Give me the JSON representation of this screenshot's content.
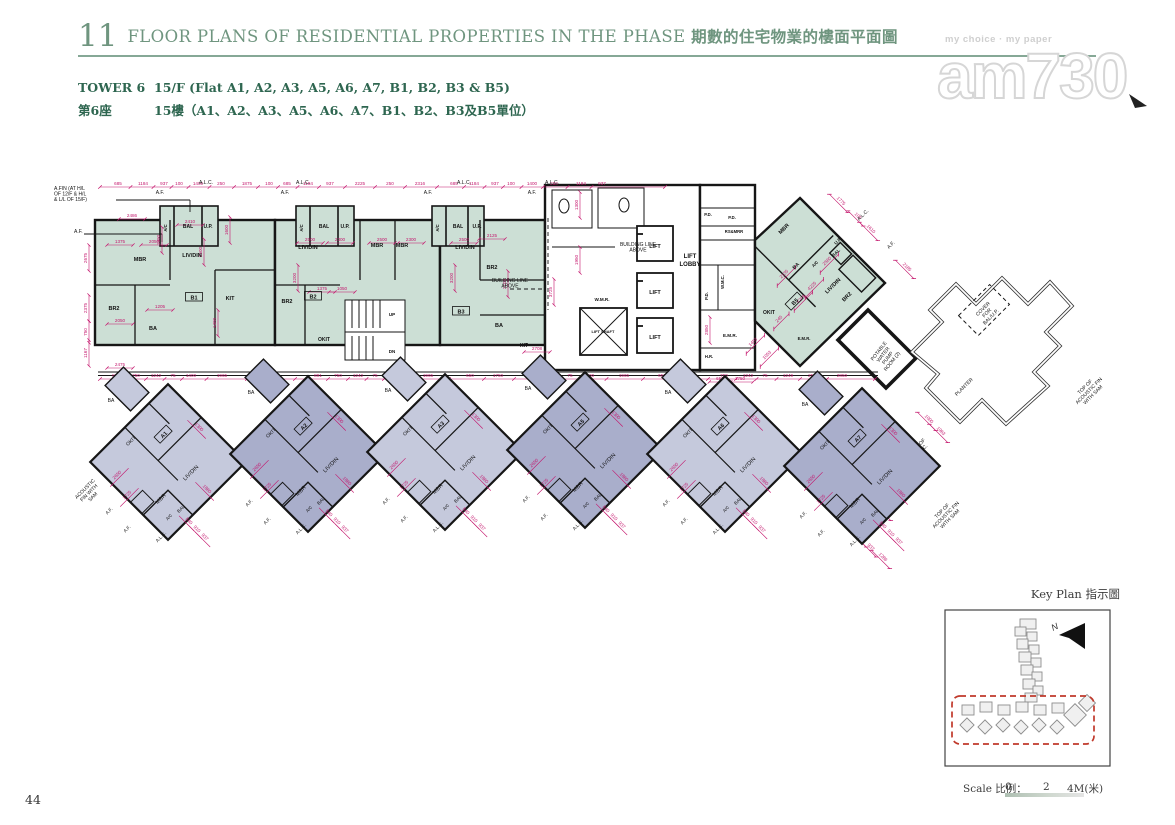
{
  "page": {
    "number": "44",
    "section_number": "11",
    "title_en": "FLOOR PLANS OF RESIDENTIAL PROPERTIES IN THE PHASE",
    "title_zh": "期數的住宅物業的樓面平面圖",
    "tower_label_en": "TOWER 6",
    "tower_label_zh": "第6座",
    "floor_label_en": "15/F (Flat A1, A2, A3, A5, A6, A7, B1, B2, B3 & B5)",
    "floor_label_zh": "15樓（A1、A2、A3、A5、A6、A7、B1、B2、B3及B5單位）"
  },
  "watermark": {
    "tagline": "my choice · my paper",
    "logo": "am730"
  },
  "key_plan": {
    "title": "Key Plan 指示圖",
    "north_label": "N",
    "scale_label": "Scale 比例：",
    "tick_0": "0",
    "tick_1": "2",
    "tick_2": "4M(米)"
  },
  "colors": {
    "header_green": "#6f957f",
    "header_dark_green": "#2e6650",
    "rule": "#86a896",
    "wall": "#161616",
    "dim": "#c4156c",
    "teal": "#ccdfd5",
    "purple_light": "#c5c9dc",
    "purple_dark": "#a9aecb",
    "keyplan_red": "#c0392b",
    "keyplan_gray": "#8d8d8d"
  },
  "plan": {
    "room_labels": [
      [
        "MBR",
        100,
        101
      ],
      [
        "LIV/DIN",
        152,
        97
      ],
      [
        "BR2",
        74,
        150
      ],
      [
        "BA",
        113,
        170
      ],
      [
        "KIT",
        190,
        140
      ],
      [
        "A/C",
        127,
        68,
        -90,
        4.2
      ],
      [
        "BAL",
        148,
        68,
        0,
        5
      ],
      [
        "U.P.",
        168,
        68,
        0,
        5
      ],
      [
        "LIV/DIN",
        268,
        89
      ],
      [
        "MBR",
        337,
        87
      ],
      [
        "BR2",
        247,
        143
      ],
      [
        "OKIT",
        284,
        181,
        0,
        5
      ],
      [
        "A/C",
        263,
        68,
        -90,
        4.2
      ],
      [
        "BAL",
        284,
        68,
        0,
        5
      ],
      [
        "U.P.",
        305,
        68,
        0,
        5
      ],
      [
        "UP",
        352,
        156,
        0,
        4.5
      ],
      [
        "DN",
        352,
        193,
        0,
        4.5
      ],
      [
        "MBR",
        362,
        87
      ],
      [
        "LIV/DIN",
        425,
        89
      ],
      [
        "BR2",
        452,
        109
      ],
      [
        "BA",
        459,
        167
      ],
      [
        "KIT",
        484,
        187,
        0,
        5
      ],
      [
        "A/C",
        399,
        68,
        -90,
        4.2
      ],
      [
        "BAL",
        418,
        68,
        0,
        5
      ],
      [
        "U.P.",
        437,
        68,
        0,
        5
      ],
      [
        "W.M.R.",
        562,
        141,
        0,
        4.6
      ],
      [
        "LIFT",
        615,
        88,
        0,
        5.5
      ],
      [
        "LIFT",
        615,
        134,
        0,
        5.5
      ],
      [
        "LIFT",
        615,
        179,
        0,
        5.5
      ],
      [
        "LIFT SHAFT",
        563,
        173,
        0,
        4.0
      ],
      [
        "LIFT",
        650,
        98,
        0,
        6
      ],
      [
        "LOBBY",
        650,
        106,
        0,
        6
      ],
      [
        "P.D.",
        668,
        56,
        0,
        4.2
      ],
      [
        "P.D.",
        692,
        59,
        0,
        4.2
      ],
      [
        "RS&MRR",
        694,
        73,
        0,
        4.2
      ],
      [
        "W.M.C.",
        684,
        122,
        -90,
        4.2
      ],
      [
        "P.D.",
        668,
        136,
        -90,
        4.2
      ],
      [
        "E.M.R.",
        690,
        177,
        0,
        4.6
      ],
      [
        "H.R.",
        669,
        198,
        0,
        4.2
      ],
      [
        "MBR",
        745,
        70,
        -45
      ],
      [
        "BA",
        757,
        107,
        -45,
        5
      ],
      [
        "U.P.",
        799,
        82,
        -45,
        4.6
      ],
      [
        "BAL",
        797,
        94,
        -45,
        4.6
      ],
      [
        "A/C",
        776,
        105,
        -45,
        4.2
      ],
      [
        "LIV/DIN",
        794,
        127,
        -45
      ],
      [
        "BR2",
        808,
        138,
        -45
      ],
      [
        "OKIT",
        729,
        154,
        0,
        5
      ],
      [
        "E.M.R.",
        764,
        180,
        0,
        4.2
      ]
    ],
    "unit_boxes": [
      [
        "B1",
        154,
        138,
        0
      ],
      [
        "B2",
        273,
        137,
        0
      ],
      [
        "B3",
        421,
        152,
        0
      ],
      [
        "B5",
        755,
        142,
        -45
      ]
    ],
    "annotations": [
      {
        "l": [
          "A.FIN (AT H/L",
          "OF 12/F & H/L",
          "& L/L OF 15/F)"
        ],
        "x": 14,
        "y": 30,
        "a": "start"
      },
      {
        "l": [
          "A.F."
        ],
        "x": 34,
        "y": 73,
        "a": "start"
      },
      {
        "l": [
          "BUILDING LINE",
          "ABOVE"
        ],
        "x": 598,
        "y": 86
      },
      {
        "l": [
          "BUILDING LINE",
          "ABOVE"
        ],
        "x": 470,
        "y": 122
      },
      {
        "l": [
          "ACOUSTIC",
          "FIN WITH",
          "SAM"
        ],
        "x": 46,
        "y": 330,
        "r": -45
      },
      {
        "l": [
          "POTABLE",
          "WATER",
          "PUMP",
          "ROOM (2)"
        ],
        "x": 840,
        "y": 192,
        "r": -52
      },
      {
        "l": [
          "PLANTER"
        ],
        "x": 925,
        "y": 228,
        "r": -45
      },
      {
        "l": [
          "COVER",
          "FOR",
          "BAL/U.P."
        ],
        "x": 944,
        "y": 150,
        "r": -45
      },
      {
        "l": [
          "TOP OF",
          "ACOUSTIC FIN",
          "WITH SAM"
        ],
        "x": 1046,
        "y": 228,
        "r": -45
      },
      {
        "l": [
          "TOP OF",
          "A.L.C."
        ],
        "x": 879,
        "y": 287,
        "r": -45
      },
      {
        "l": [
          "A.F."
        ],
        "x": 860,
        "y": 307,
        "r": -45
      },
      {
        "l": [
          "TOP OF",
          "ACOUSTIC FIN",
          "WITH SAM"
        ],
        "x": 903,
        "y": 352,
        "r": -45
      },
      {
        "l": [
          "A.F."
        ],
        "x": 120,
        "y": 34
      },
      {
        "l": [
          "A.L.C."
        ],
        "x": 166,
        "y": 24
      },
      {
        "l": [
          "A.F."
        ],
        "x": 245,
        "y": 34
      },
      {
        "l": [
          "A.L.C."
        ],
        "x": 263,
        "y": 24
      },
      {
        "l": [
          "A.F."
        ],
        "x": 388,
        "y": 34
      },
      {
        "l": [
          "A.L.C."
        ],
        "x": 424,
        "y": 24
      },
      {
        "l": [
          "A.F."
        ],
        "x": 492,
        "y": 34
      },
      {
        "l": [
          "A.L.C."
        ],
        "x": 512,
        "y": 24
      },
      {
        "l": [
          "A.L.C."
        ],
        "x": 824,
        "y": 56,
        "r": -45
      },
      {
        "l": [
          "A.F."
        ],
        "x": 852,
        "y": 86,
        "r": -45
      }
    ],
    "dim_top": {
      "y": 27,
      "x1": 60,
      "x2": 625,
      "labels": [
        [
          "685",
          78
        ],
        [
          "1184",
          103
        ],
        [
          "937",
          124
        ],
        [
          "100",
          139
        ],
        [
          "1400",
          158
        ],
        [
          "250",
          181
        ],
        [
          "1875",
          207
        ],
        [
          "100",
          229
        ],
        [
          "685",
          247
        ],
        [
          "1184",
          268
        ],
        [
          "937",
          290
        ],
        [
          "2225",
          320
        ],
        [
          "250",
          350
        ],
        [
          "2316",
          380
        ],
        [
          "685",
          414
        ],
        [
          "1184",
          434
        ],
        [
          "937",
          455
        ],
        [
          "100",
          471
        ],
        [
          "1400",
          492
        ],
        [
          "250",
          514
        ],
        [
          "1184",
          541
        ],
        [
          "937",
          562
        ]
      ]
    },
    "dim_mid": {
      "y": 219,
      "x1": 60,
      "x2": 835,
      "labels": [
        [
          "891",
          76
        ],
        [
          "750",
          96
        ],
        [
          "1242",
          116
        ],
        [
          "75",
          133
        ],
        [
          "1400",
          151
        ],
        [
          "1965",
          182
        ],
        [
          "4850",
          232
        ],
        [
          "891",
          278
        ],
        [
          "750",
          298
        ],
        [
          "1242",
          318
        ],
        [
          "75",
          335
        ],
        [
          "1400",
          353
        ],
        [
          "1965",
          388
        ],
        [
          "650",
          430
        ],
        [
          "1750",
          458
        ],
        [
          "750",
          490
        ],
        [
          "1242",
          513
        ],
        [
          "75",
          530
        ],
        [
          "1400",
          549
        ],
        [
          "1965",
          584
        ],
        [
          "650",
          622
        ],
        [
          "1750",
          652
        ],
        [
          "750",
          684
        ],
        [
          "1242",
          708
        ],
        [
          "75",
          725
        ],
        [
          "1249",
          748
        ],
        [
          "250",
          772
        ],
        [
          "2850",
          802
        ]
      ]
    },
    "scatter": [
      [
        "2486",
        92,
        57
      ],
      [
        "2410",
        150,
        63
      ],
      [
        "1390",
        120,
        80,
        -90
      ],
      [
        "1375",
        80,
        83
      ],
      [
        "2050",
        114,
        83
      ],
      [
        "1205",
        120,
        148
      ],
      [
        "2050",
        80,
        162
      ],
      [
        "2475",
        80,
        206
      ],
      [
        "1600",
        188,
        70,
        -90
      ],
      [
        "2500",
        162,
        92,
        -90
      ],
      [
        "1400",
        176,
        163,
        -90
      ],
      [
        "2500",
        270,
        81
      ],
      [
        "2300",
        300,
        81
      ],
      [
        "3200",
        256,
        118,
        -90
      ],
      [
        "2125",
        452,
        77
      ],
      [
        "2500",
        342,
        81
      ],
      [
        "2300",
        371,
        81
      ],
      [
        "2500",
        424,
        81
      ],
      [
        "3200",
        413,
        118,
        -90
      ],
      [
        "2100",
        466,
        124,
        -90
      ],
      [
        "1050",
        302,
        130
      ],
      [
        "1375",
        282,
        130
      ],
      [
        "2675",
        47,
        98,
        -90
      ],
      [
        "2375",
        47,
        148,
        -90
      ],
      [
        "750",
        47,
        172,
        -90
      ],
      [
        "1167",
        47,
        193,
        -90
      ],
      [
        "4225",
        773,
        127,
        -45
      ],
      [
        "4289",
        762,
        140,
        -45
      ],
      [
        "2560",
        788,
        102,
        -45
      ],
      [
        "1610",
        830,
        70,
        45
      ],
      [
        "105",
        817,
        57,
        45
      ],
      [
        "1775",
        800,
        42,
        45
      ],
      [
        "2185",
        866,
        108,
        45
      ],
      [
        "1963",
        900,
        272,
        45
      ],
      [
        "1000",
        888,
        260,
        45
      ],
      [
        "3725",
        512,
        132,
        -90
      ],
      [
        "2850",
        668,
        170,
        -90
      ],
      [
        "1750",
        700,
        220
      ],
      [
        "650",
        680,
        220
      ],
      [
        "2708",
        497,
        190
      ],
      [
        "1860",
        843,
        350,
        45
      ],
      [
        "55",
        800,
        356,
        45
      ],
      [
        "840",
        810,
        368,
        45
      ],
      [
        "910",
        820,
        378,
        45
      ],
      [
        "937",
        830,
        388,
        45
      ],
      [
        "1286",
        842,
        398,
        45
      ],
      [
        "1300",
        538,
        45,
        -90
      ],
      [
        "1950",
        538,
        100,
        -90
      ],
      [
        "245",
        740,
        160,
        -45
      ],
      [
        "1053",
        728,
        196,
        -45
      ],
      [
        "1453",
        714,
        183,
        -45
      ],
      [
        "2135",
        745,
        115,
        -45
      ]
    ],
    "bottom_units": [
      {
        "id": "A1",
        "cx": 128,
        "cy": 302,
        "shade": "light"
      },
      {
        "id": "A2",
        "cx": 268,
        "cy": 294,
        "shade": "dark"
      },
      {
        "id": "A3",
        "cx": 405,
        "cy": 292,
        "shade": "light"
      },
      {
        "id": "A5",
        "cx": 545,
        "cy": 290,
        "shade": "dark"
      },
      {
        "id": "A6",
        "cx": 685,
        "cy": 294,
        "shade": "light"
      },
      {
        "id": "A7",
        "cx": 822,
        "cy": 306,
        "shade": "dark"
      }
    ],
    "diamond_rooms": [
      [
        "BA",
        -57,
        -60,
        0,
        5
      ],
      [
        "OKIT",
        -36,
        -20,
        -45,
        5
      ],
      [
        "LIV/DIN",
        24,
        12,
        -45,
        5.5
      ],
      [
        "MBR",
        -6,
        38,
        -45,
        5.5
      ],
      [
        "BAL",
        14,
        48,
        -45,
        4.6
      ],
      [
        "A/C",
        2,
        56,
        -45,
        4.2
      ]
    ],
    "diamond_dims": [
      [
        "2650",
        -50,
        14,
        -45
      ],
      [
        "1725",
        -40,
        34,
        -45
      ],
      [
        "1860",
        38,
        28,
        45
      ],
      [
        "1300",
        30,
        -34,
        45
      ],
      [
        "840",
        20,
        60,
        45
      ],
      [
        "910",
        28,
        68,
        45
      ],
      [
        "937",
        36,
        76,
        45
      ]
    ],
    "diamond_annos": [
      [
        "A.F.",
        -58,
        50,
        -45
      ],
      [
        "A.L.C.",
        -6,
        76,
        -45
      ],
      [
        "A.F.",
        -40,
        68,
        -45
      ]
    ]
  }
}
